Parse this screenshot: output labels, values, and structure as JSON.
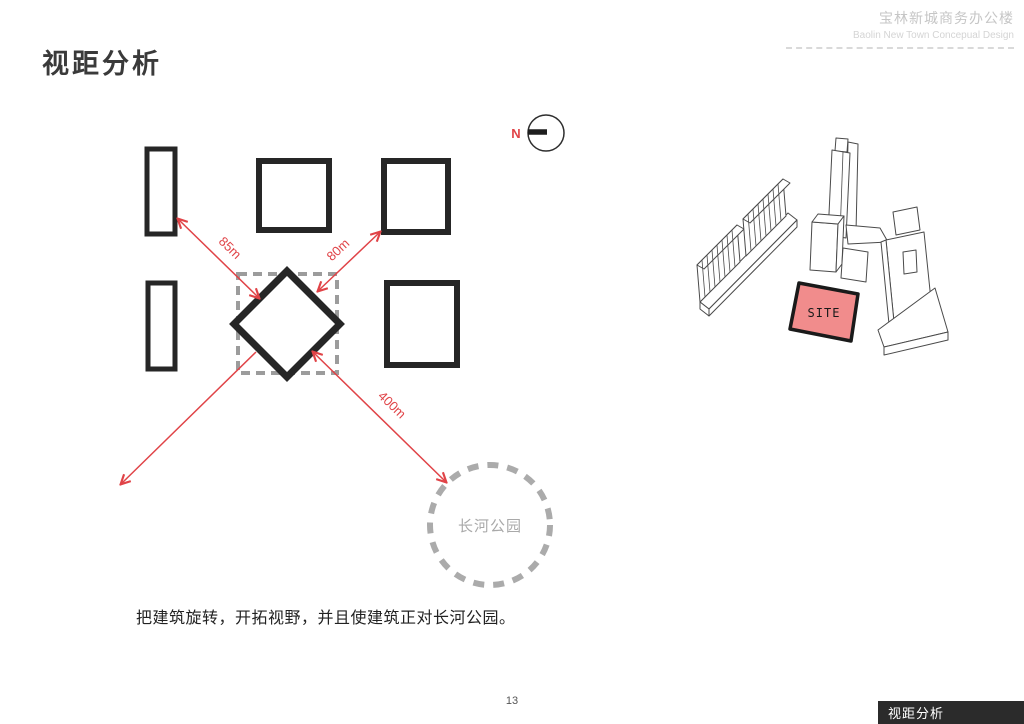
{
  "header": {
    "project_title_zh": "宝林新城商务办公楼",
    "project_title_en": "Baolin New Town Concepual Design"
  },
  "page": {
    "title": "视距分析",
    "caption": "把建筑旋转，开拓视野，并且使建筑正对长河公园。",
    "page_number": "13",
    "footer_tab": "视距分析"
  },
  "diagram": {
    "north_label": "N",
    "distances": {
      "to_left_slab": "85m",
      "to_right_square": "80m",
      "to_park": "400m"
    },
    "park_label": "长河公园",
    "site_label": "SITE"
  },
  "colors": {
    "arrow_red": "#e04347",
    "site_pink": "#f18c8c",
    "building_outline": "#262626",
    "dashed_gray": "#9c9c9c",
    "footer_bg": "#2b2b2b"
  }
}
